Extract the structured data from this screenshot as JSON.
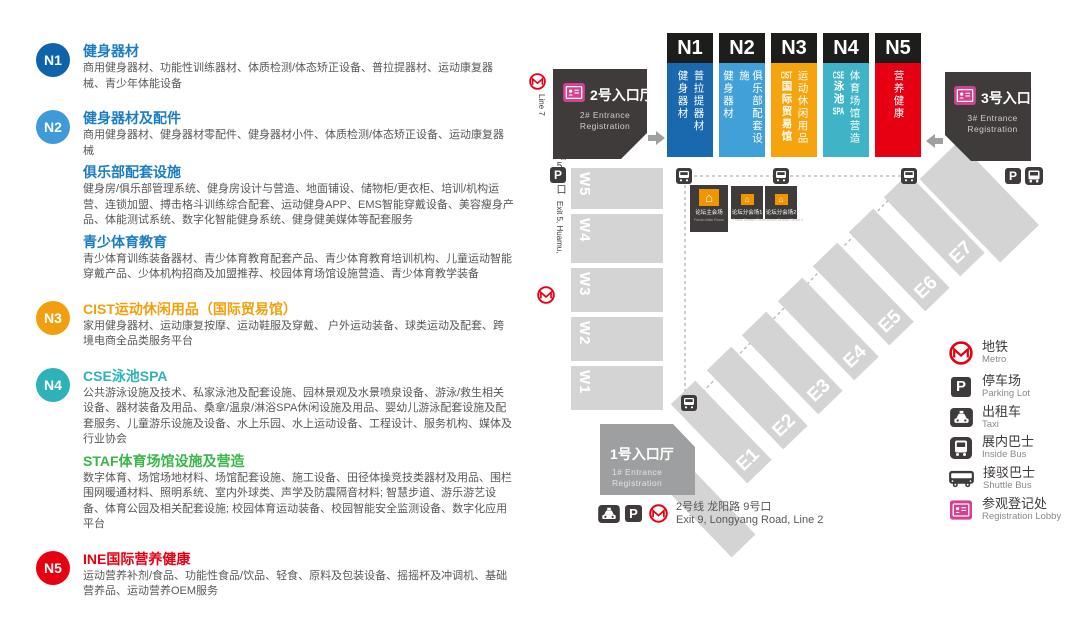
{
  "colors": {
    "n1_blue": "#0e63aa",
    "n2_blue": "#3f9bd8",
    "n3_orange": "#f0a00e",
    "n4_teal": "#2eb1b7",
    "n5_red": "#e60012",
    "staf_green": "#3ab549",
    "map_n1": "#1a69af",
    "map_n2": "#41a0d8",
    "map_n3": "#f6a40d",
    "map_n4": "#3fb4c6",
    "map_n5": "#e60012",
    "hall_gray": "#d4d4d5",
    "dark": "#3f3b3a",
    "badge_pink": "#d6418f",
    "metro_red": "#e60012"
  },
  "left_panel": {
    "sections": [
      {
        "badge": "N1",
        "groups": [
          {
            "title": "健身器材",
            "desc": "商用健身器材、功能性训练器材、体质检测/体态矫正设备、普拉提器材、运动康复器械、青少年体能设备"
          }
        ]
      },
      {
        "badge": "N2",
        "groups": [
          {
            "title": "健身器材及配件",
            "desc": "商用健身器材、健身器材零配件、健身器材小件、体质检测/体态矫正设备、运动康复器械"
          },
          {
            "title": "俱乐部配套设施",
            "desc": "健身房/俱乐部管理系统、健身房设计与营造、地面铺设、储物柜/更衣柜、培训/机构运营、连锁加盟、搏击格斗训练综合配套、运动健身APP、EMS智能穿戴设备、美容瘦身产品、体能测试系统、数字化智能健身系统、健身健美媒体等配套服务"
          },
          {
            "title": "青少体育教育",
            "desc": "青少体育训练装备器材、青少体育教育配套产品、青少体育教育培训机构、儿童运动智能穿戴产品、少体机构招商及加盟推荐、校园体育场馆设施营造、青少体育教学装备"
          }
        ]
      },
      {
        "badge": "N3",
        "groups": [
          {
            "title": "CIST运动休闲用品（国际贸易馆）",
            "desc": "家用健身器材、运动康复按摩、运动鞋服及穿戴、 户外运动装备、球类运动及配套、跨境电商全品类服务平台"
          }
        ]
      },
      {
        "badge": "N4",
        "groups": [
          {
            "title": "CSE泳池SPA",
            "desc": "公共游泳设施及技术、私家泳池及配套设施、园林景观及水景喷泉设备、游泳/救生相关设备、器材装备及用品、桑拿/温泉/淋浴SPA休闲设施及用品、婴幼儿游泳配套设施及配套服务、儿童游乐设施及设备、水上乐园、水上运动设备、工程设计、服务机构、媒体及行业协会"
          },
          {
            "title": "STAF体育场馆设施及营造",
            "desc": "数字体育、场馆场地材料、场馆配套设施、施工设备、田径体操竞技类器材及用品、围栏围网暖通材料、照明系统、室内外球类、声学及防震隔音材料; 智慧步道、游乐游艺设备、体育公园及相关配套设施; 校园体育运动装备、校园智能安全监测设备、数字化应用平台"
          }
        ]
      },
      {
        "badge": "N5",
        "groups": [
          {
            "title": "INE国际营养健康",
            "desc": "运动营养补剂/食品、功能性食品/饮品、轻食、原料及包装设备、摇摇杯及冲调机、基础营养品、运动营养OEM服务"
          }
        ]
      }
    ]
  },
  "map": {
    "metro_line7": {
      "cjk": "7号线花木站5号口",
      "en": "Exit 5, Huamu, Line 7"
    },
    "metro_line2": {
      "cjk": "2号线 龙阳路 9号口",
      "en": "Exit 9, Longyang Road, Line 2"
    },
    "entrance2": {
      "title": "2号入口厅",
      "sub1": "2# Entrance",
      "sub2": "Registration"
    },
    "entrance3": {
      "title": "3号入口厅",
      "sub1": "3# Entrance",
      "sub2": "Registration"
    },
    "entrance1": {
      "title": "1号入口厅",
      "sub1": "1# Entrance",
      "sub2": "Registration"
    },
    "halls_n": [
      {
        "id": "N1",
        "col1": "健身器材",
        "col2": "普拉提器材"
      },
      {
        "id": "N2",
        "col1": "健身器材",
        "col2": "俱乐部配套设施"
      },
      {
        "id": "N3",
        "col1_lat": "CIST",
        "col1": "国际贸易馆",
        "col2": "运动休闲用品"
      },
      {
        "id": "N4",
        "col1_lat": "CSE",
        "col1": "泳池",
        "col1_lat2": "SPA",
        "col2": "体育场馆营造"
      },
      {
        "id": "N5",
        "col1": "营养健康"
      }
    ],
    "halls_w": [
      "W5",
      "W4",
      "W3",
      "W2",
      "W1"
    ],
    "halls_e": [
      "E1",
      "E2",
      "E3",
      "E4",
      "E5",
      "E6",
      "E7"
    ],
    "forum": {
      "main": {
        "cjk": "论坛主会场",
        "en": "Forum Main Room"
      },
      "b1": {
        "cjk": "论坛分会场1",
        "en": "Forum Branch Room 1"
      },
      "b2": {
        "cjk": "论坛分会场2",
        "en": "Forum Branch Room 2"
      }
    },
    "legend": [
      {
        "cjk": "地铁",
        "en": "Metro"
      },
      {
        "cjk": "停车场",
        "en": "Parking Lot"
      },
      {
        "cjk": "出租车",
        "en": "Taxi"
      },
      {
        "cjk": "展内巴士",
        "en": "Inside Bus"
      },
      {
        "cjk": "接驳巴士",
        "en": "Shuttle Bus"
      },
      {
        "cjk": "参观登记处",
        "en": "Registration Lobby"
      }
    ],
    "p_label": "P"
  }
}
